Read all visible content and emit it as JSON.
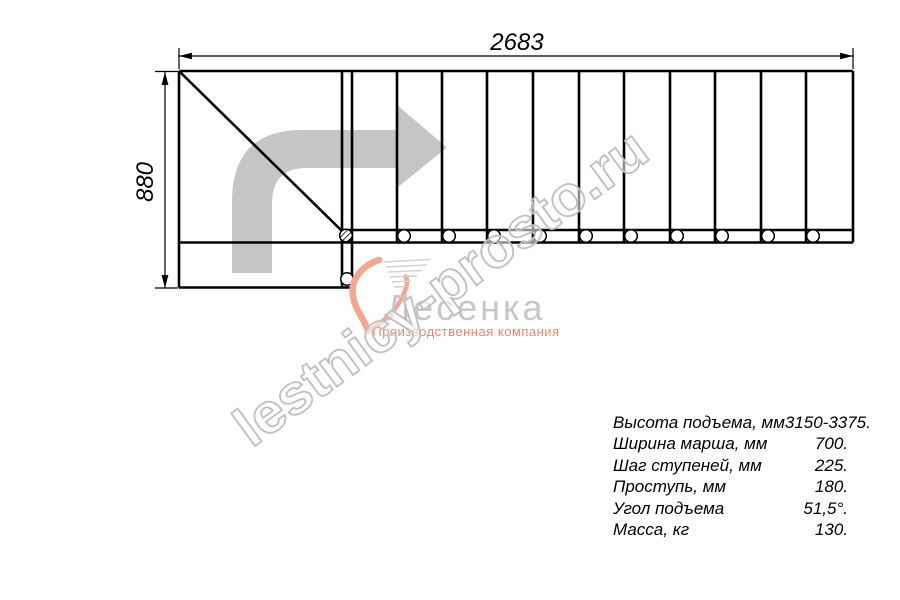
{
  "drawing": {
    "type": "staircase-plan-top-view",
    "width_dimension": "2683",
    "height_dimension": "880",
    "tread_lines_count": 12,
    "mounting_holes_count": 12
  },
  "watermark": {
    "text": "lestnicy-prosto.ru"
  },
  "logo": {
    "name": "Лесенка",
    "tagline": "Производственная компания"
  },
  "specs": {
    "rows": [
      {
        "label": "Высота подъема, мм",
        "value": "3150-3375."
      },
      {
        "label": "Ширина марша, мм",
        "value": "700."
      },
      {
        "label": "Шаг ступеней, мм",
        "value": "225."
      },
      {
        "label": "Проступь, мм",
        "value": "180."
      },
      {
        "label": "Угол подъема",
        "value": "51,5°."
      },
      {
        "label": "Масса, кг",
        "value": "130."
      }
    ]
  },
  "colors": {
    "line": "#000000",
    "direction_arrow": "#c5c5c5",
    "watermark_outline": "#c0c0c0",
    "logo_text": "#c7c7c7",
    "logo_accent": "#f0856a"
  }
}
